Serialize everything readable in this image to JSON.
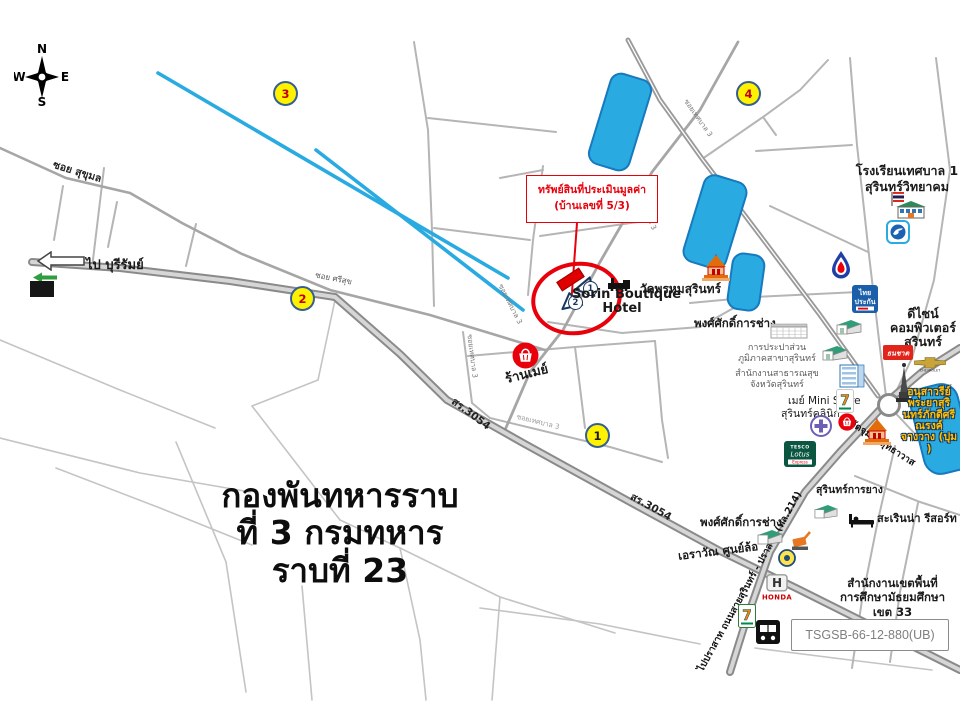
{
  "colors": {
    "water": "#29ABE2",
    "highlight_red": "#E8000B",
    "marker_yellow": "#FFF200",
    "road_gray": "#8A8A8A",
    "monument_text": "#FFC000"
  },
  "compass": {
    "n": "N",
    "e": "E",
    "s": "S",
    "w": "W"
  },
  "callout": {
    "line1": "ทรัพย์สินที่ประเมินมูลค่า",
    "line2": "(บ้านเลขที่ 5/3)"
  },
  "military": {
    "line1": "กองพันทหารราบ",
    "line2": "ที่ 3 กรมทหาร",
    "line3": "ราบที่ 23"
  },
  "ref_code": "TSGSB-66-12-880(UB)",
  "markers": {
    "m1": "1",
    "m2": "2",
    "m3": "3",
    "m4": "4"
  },
  "viewpoints": {
    "v1": "1",
    "v2": "2"
  },
  "roads": {
    "soi_sukhumol": "ซอย สุขุมล",
    "soi_srisuk": "ซอย ศรีสุข",
    "soi_thetsaban": "ซอยเทศบาล 3",
    "sr3054": "สร.3054",
    "surin_prasat": "ไปปราสาท ถนนสายสุรินทร์ - ปราสาท (ทล.214)",
    "to_buriram": "ไป บุรีรัมย์"
  },
  "places": {
    "hotel_line1": "Sorin Boutique",
    "hotel_line2": "Hotel",
    "wat_prohm": "วัดพรหมสุรินทร์",
    "wat_jumpol": "วัดจุมพลสุทธาวาส",
    "school_line1": "โรงเรียนเทศบาล 1",
    "school_line2": "สุรินทร์วิทยาคม",
    "design_line1": "ดีไซน์",
    "design_line2": "คอมพิวเตอร์",
    "design_line3": "สุรินทร์",
    "monument_lines": [
      "อนุสาวรีย์",
      "พระยาสุริ",
      "นทร์ภักดีศรี",
      "ณรงค์",
      "จางวาง (ปุม",
      ")"
    ],
    "pongsak": "พงศ์ศักดิ์การช่าง",
    "waterworks_line1": "การประปาส่วน",
    "waterworks_line2": "ภูมิภาคสาขาสุรินทร์",
    "health_line1": "สำนักงานสาธารณสุข",
    "health_line2": "จังหวัดสุรินทร์",
    "ministore_line1": "เมย์ Mini Store",
    "ministore_line2": "สุรินทร์คลินิก",
    "tire": "สุรินทร์การยาง",
    "resort": "สะเรินน่า รีสอร์ท",
    "edu_line1": "สำนักงานเขตพื้นที่",
    "edu_line2": "การศึกษามัธยมศึกษา",
    "edu_line3": "เขต 33",
    "erawan": "เอราวัณ ศูนย์ล้อ",
    "ranmay": "ร้านเมย์",
    "thai_ins_line1": "ไทย",
    "thai_ins_line2": "ประกัน",
    "thanachart": "ธนชาต",
    "chevrolet": "CHEVROLET",
    "honda": "HONDA",
    "honda_h": "H",
    "seven": "7",
    "tesco_line1": "TESCO",
    "tesco_line2": "Lotus",
    "tesco_line3": "Express"
  }
}
